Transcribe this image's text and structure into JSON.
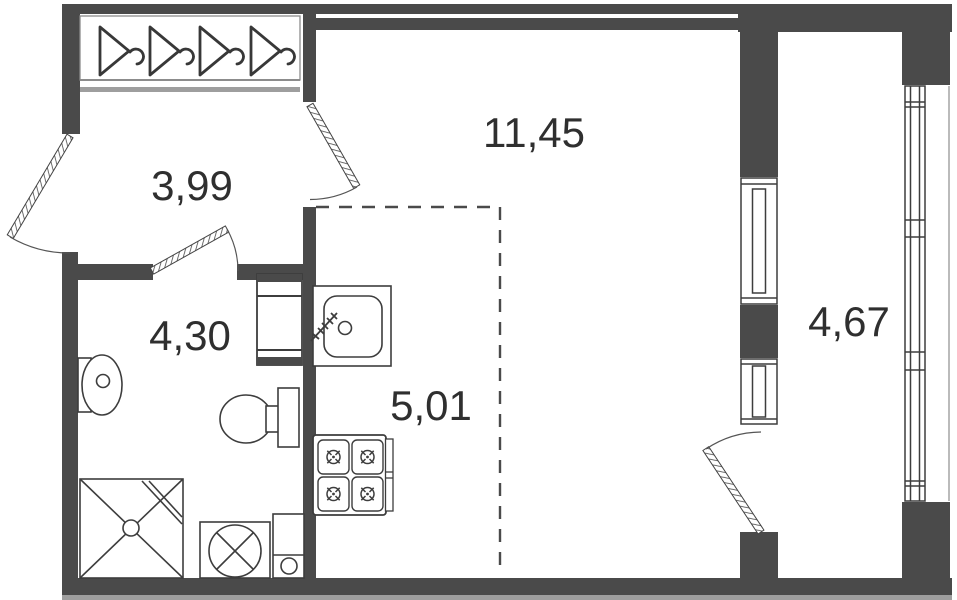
{
  "plan_type": "studio-apartment-floor-plan",
  "rooms": {
    "hallway": {
      "label": "3,99"
    },
    "living": {
      "label": "11,45"
    },
    "bathroom": {
      "label": "4,30"
    },
    "kitchen": {
      "label": "5,01"
    },
    "balcony": {
      "label": "4,67"
    }
  },
  "colors": {
    "wall": "#4a4a4a",
    "fixture_line": "#3d3d3d",
    "light_gray": "#9e9e9e",
    "frame_gray": "#8c8c8c",
    "label_text": "#2f2f2f",
    "background": "#ffffff"
  },
  "icons": [
    "hanger-icon",
    "wash-basin-icon",
    "toilet-icon",
    "shower-icon",
    "washing-machine-icon",
    "riser-icon",
    "ventilation-shaft-icon",
    "kitchen-sink-icon",
    "stove-icon",
    "burner-icon"
  ],
  "doors": [
    "entrance-door",
    "room-door",
    "bathroom-door",
    "balcony-door"
  ],
  "windows": [
    "window-living-room",
    "window-balcony-block",
    "balcony-glazing"
  ]
}
